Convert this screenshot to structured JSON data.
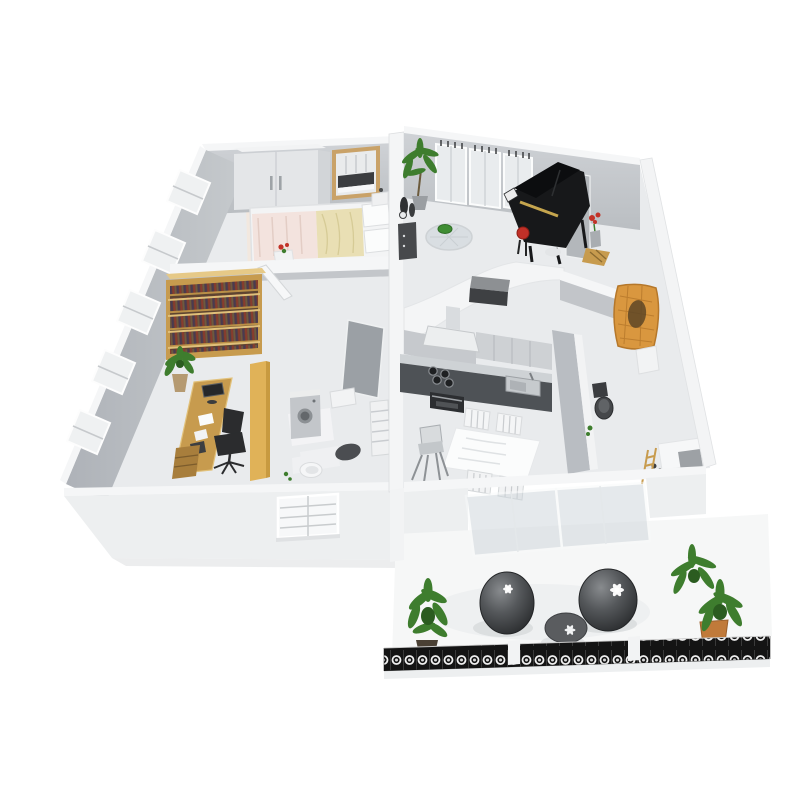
{
  "title": "3D isometric cutaway floor plan of an apartment",
  "background": "#ffffff",
  "palette": {
    "wallTop": "#f5f6f7",
    "wallFace": "#c2c5c9",
    "wallFaceDark": "#b2b6bc",
    "exteriorWall": "#edeff0",
    "floor": "#e9ebed",
    "rugWarm": "#f2e8df",
    "bedding": "#e9dfb4",
    "sheet": "#f3e3de",
    "wood": "#c79b4e",
    "woodLight": "#e0b258",
    "woodDark": "#a87e3c",
    "gold": "#c9a268",
    "piano": "#17181a",
    "pianoAccent": "#d8b554",
    "stoolRed": "#c03028",
    "red": "#c23227",
    "green": "#3e7d2e",
    "greenDark": "#2b5c20",
    "cabinet": "#ced1d4",
    "counter": "#4e5256",
    "appliance": "#c3c6ca",
    "wicker": "#d9973f",
    "terracotta": "#c07a3a",
    "poufDark": "#2e3033",
    "railing": "#141414",
    "glass": "#cdd5da"
  },
  "rooms": [
    {
      "name": "Bedroom",
      "position": "top-left",
      "furniture": [
        "white wardrobe",
        "gold framed mirror",
        "double bed",
        "pink striped sheet",
        "beige duvet",
        "two pillows",
        "nightstand",
        "flower side table",
        "windows with blinds"
      ]
    },
    {
      "name": "Living room",
      "position": "top-right",
      "furniture": [
        "black grand piano",
        "red piano stool",
        "tall windows with curtain hooks",
        "potted palm",
        "dark decor cabinet with vases",
        "glass coffee table with green bowl",
        "curved white partition with dark media unit",
        "red flowers",
        "wooden magazine rack"
      ]
    },
    {
      "name": "Study",
      "position": "middle-left",
      "furniture": [
        "wooden bookshelf full of books",
        "wooden desk",
        "computer monitor",
        "black office chair",
        "drawer pedestal",
        "potted plant",
        "open wooden door",
        "papers on floor"
      ]
    },
    {
      "name": "Bathroom",
      "position": "center",
      "furniture": [
        "washing machine",
        "toilet",
        "wash basin",
        "towel radiator",
        "dark bath mat",
        "open grey door",
        "green bottles"
      ]
    },
    {
      "name": "Kitchen and dining",
      "position": "center-right",
      "furniture": [
        "range hood",
        "upper cabinets",
        "tall cabinet column",
        "dark counter with cooktop",
        "oven",
        "sink",
        "dining table with white tablecloth",
        "four white chairs",
        "high chair"
      ]
    },
    {
      "name": "WC",
      "position": "right",
      "furniture": [
        "dark toilet",
        "white shelf",
        "hanging wicker chair"
      ]
    },
    {
      "name": "Utility corner",
      "position": "bottom-right",
      "furniture": [
        "white side table",
        "grey storage box",
        "small step ladder",
        "dark accessories"
      ]
    },
    {
      "name": "Balcony",
      "position": "bottom",
      "furniture": [
        "round rattan pouf left",
        "round rattan pouf right",
        "round side table",
        "white flower cushions",
        "green potted plants",
        "terracotta planter",
        "ornate black iron railing",
        "tilted glass doors"
      ]
    }
  ],
  "structure": {
    "view": "isometric cutaway from above",
    "exterior_walls": "white",
    "interior_walls": "light grey",
    "wings": [
      "left wing: bedroom, study, bathroom",
      "right wing: living room, kitchen, WC",
      "front: balcony terrace"
    ]
  }
}
